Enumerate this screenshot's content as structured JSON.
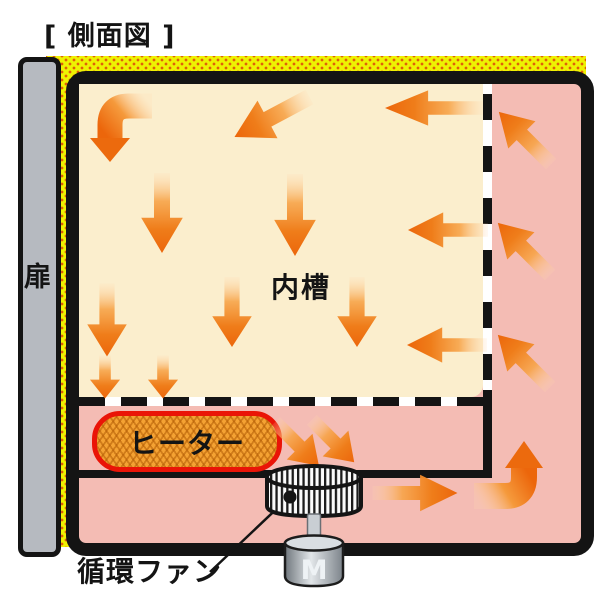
{
  "title": "[ 側面図 ]",
  "diagram": {
    "type": "oven-airflow-side-view",
    "labels": {
      "door": "扉",
      "inner_chamber": "内槽",
      "heater": "ヒーター",
      "circulation_fan": "循環ファン",
      "motor": "M"
    },
    "colors": {
      "insulation_yellow": "#eef202",
      "insulation_dot": "#e06008",
      "duct_pink": "#f4bcb4",
      "chamber_cream": "#fbeecd",
      "outline_black": "#141414",
      "door_gray": "#b6bac0",
      "heater_fill": "#f4a233",
      "heater_border": "#ea1407",
      "arrow_orange": "#ed6d0e"
    }
  }
}
